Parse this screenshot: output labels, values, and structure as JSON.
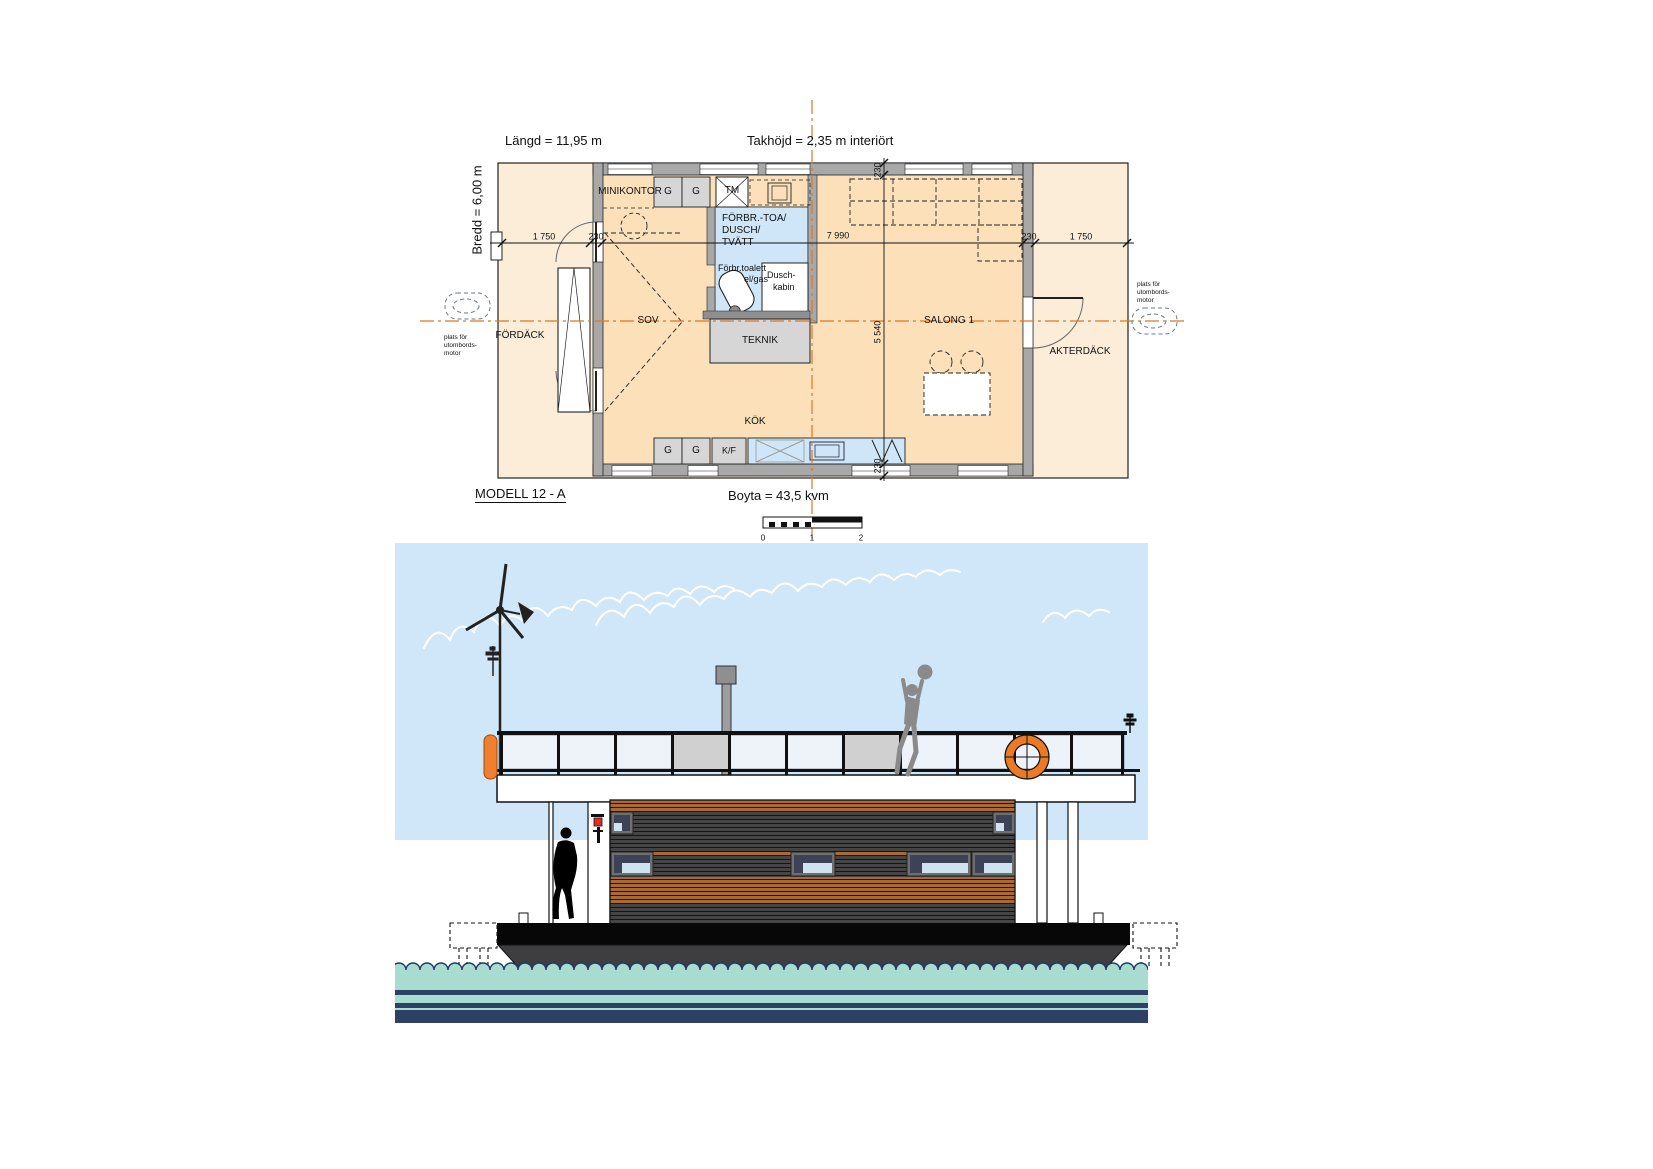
{
  "sheet": {
    "floor_plan": {
      "header": {
        "length_label": "Längd = 11,95 m",
        "height_label": "Takhöjd = 2,35 m interiört",
        "width_label": "Bredd = 6,00 m"
      },
      "footer": {
        "model_label": "MODELL 12 - A",
        "area_label": "Boyta = 43,5 kvm"
      },
      "rooms": {
        "minikontor": "MINIKONTOR",
        "bathroom_line1": "FÖRBR.-TOA/",
        "bathroom_line2": "DUSCH/",
        "bathroom_line3": "TVÄTT",
        "toilet_line1": "Förbr.toalett",
        "toilet_line2": "el/gas",
        "shower_line1": "Dusch-",
        "shower_line2": "kabin",
        "sleeping": "SOV",
        "tech": "TEKNIK",
        "salon": "SALONG 1",
        "kitchen": "KÖK",
        "foredeck": "FÖRDÄCK",
        "aftdeck": "AKTERDÄCK"
      },
      "cabinets": {
        "washing_machine": "TM",
        "g_top_1": "G",
        "g_top_2": "G",
        "g_bottom_1": "G",
        "g_bottom_2": "G",
        "fridge_freezer": "K/F"
      },
      "motor_note_left": {
        "line1": "plats för",
        "line2": "utombords-",
        "line3": "motor"
      },
      "motor_note_right": {
        "line1": "plats för",
        "line2": "utombords-",
        "line3": "motor"
      },
      "dimensions": {
        "h_chain": [
          "1 750",
          "230",
          "7 990",
          "230",
          "1 750"
        ],
        "v_chain": [
          "230",
          "5 540",
          "230"
        ]
      },
      "scale_bar": {
        "ticks": [
          "0",
          "1",
          "2"
        ]
      }
    }
  },
  "colors": {
    "sky": "#cfe7f8",
    "waterTeal": "#a9dcd1",
    "waterNavy": "#2d4166",
    "waveLine": "#1d3a66",
    "hullBlack": "#070707",
    "hullGray": "#3e3e40",
    "wood": "#a96b30",
    "woodLine": "#241405",
    "slatGray": "#454545",
    "slatLine": "#141414",
    "panel": "#eef2f9",
    "panelGray": "#d0d0d0",
    "buoy": "#ea7a24",
    "fender": "#ef8030",
    "personGray": "#8a8a8a",
    "planInterior": "#fbe0ba",
    "planDeck": "#fcedd8",
    "planWet": "#cee6f7",
    "planWall": "#a8a8a8",
    "planRoomGray": "#d6d6d6",
    "centerline": "#dd7722",
    "glass": "#3d4257",
    "glassLight": "#cfe2f0",
    "frame": "#6f6f6f",
    "chimney": "#9e9e9e",
    "lampRed": "#e03020"
  }
}
